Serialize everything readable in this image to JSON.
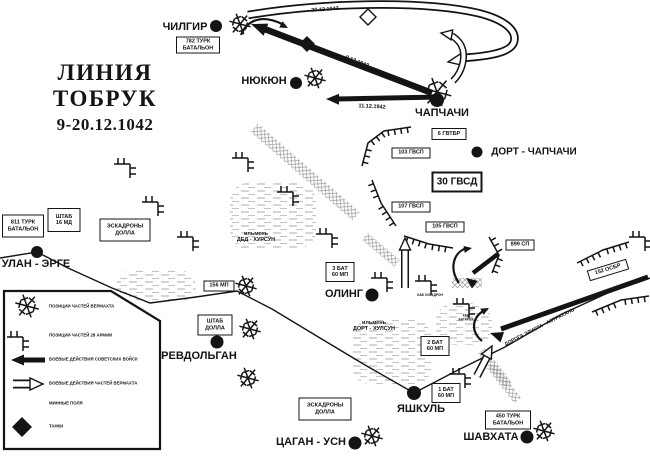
{
  "colors": {
    "ink": "#141414",
    "water": "#b4b4b4",
    "mine": "#9a9a9a",
    "bg": "#ffffff"
  },
  "title": {
    "line1": "ЛИНИЯ  ТОБРУК",
    "line2": "9-20.12.1042"
  },
  "towns": [
    {
      "name": "ЧИЛГИР",
      "dot": [
        216,
        26
      ],
      "r": 6,
      "label": [
        185,
        27
      ],
      "fs": 11
    },
    {
      "name": "НЮКЮН",
      "dot": [
        296,
        83
      ],
      "r": 6,
      "label": [
        264,
        81
      ],
      "fs": 11
    },
    {
      "name": "ЧАПЧАЧИ",
      "dot": [
        437,
        100
      ],
      "r": 7,
      "label": [
        442,
        113
      ],
      "fs": 11
    },
    {
      "name": "ДОРТ - ЧАПЧАЧИ",
      "dot": [
        477,
        152
      ],
      "r": 5.5,
      "label": [
        534,
        152
      ],
      "fs": 10
    },
    {
      "name": "УЛАН - ЭРГЕ",
      "dot": [
        37,
        252
      ],
      "r": 6,
      "label": [
        36,
        264
      ],
      "fs": 11
    },
    {
      "name": "РЕВДОЛЬГАН",
      "dot": [
        217,
        342
      ],
      "r": 6.5,
      "label": [
        199,
        356
      ],
      "fs": 11
    },
    {
      "name": "ОЛИНГ",
      "dot": [
        372,
        295
      ],
      "r": 6.5,
      "label": [
        344,
        294
      ],
      "fs": 11
    },
    {
      "name": "ЯШКУЛЬ",
      "dot": [
        414,
        393
      ],
      "r": 7,
      "label": [
        421,
        409
      ],
      "fs": 11
    },
    {
      "name": "ЦАГАН - УСН",
      "dot": [
        355,
        443
      ],
      "r": 6.5,
      "label": [
        311,
        442
      ],
      "fs": 11
    },
    {
      "name": "ШАВХАТА",
      "dot": [
        527,
        437
      ],
      "r": 6.5,
      "label": [
        491,
        437
      ],
      "fs": 11
    }
  ],
  "unit_boxes": [
    {
      "lines": [
        "782 ТУРК",
        "БАТАЛЬОН"
      ],
      "c": [
        198,
        45
      ],
      "w": 44,
      "h": 17,
      "fs": 5.5,
      "bw": 1.3,
      "rot": 0
    },
    {
      "lines": [
        "811 ТУРК",
        "БАТАЛЬОН"
      ],
      "c": [
        23,
        226
      ],
      "w": 42,
      "h": 23,
      "fs": 5.5,
      "bw": 1.3,
      "rot": 0
    },
    {
      "lines": [
        "ШТАБ",
        "16 МД"
      ],
      "c": [
        64,
        220
      ],
      "w": 33,
      "h": 24,
      "fs": 5.5,
      "bw": 1.8,
      "rot": 0
    },
    {
      "lines": [
        "ЭСКАДРОНЫ",
        "ДОЛЛА"
      ],
      "c": [
        125,
        230
      ],
      "w": 51,
      "h": 23,
      "fs": 5.5,
      "bw": 1.3,
      "rot": 0
    },
    {
      "lines": [
        "156 МП"
      ],
      "c": [
        219,
        286
      ],
      "w": 31,
      "h": 11,
      "fs": 5.5,
      "bw": 1.3,
      "rot": 0
    },
    {
      "lines": [
        "ШТАБ",
        "ДОЛЛА"
      ],
      "c": [
        215,
        325
      ],
      "w": 35,
      "h": 21,
      "fs": 5.5,
      "bw": 1.8,
      "rot": 0
    },
    {
      "lines": [
        "ЭСКАДРОНЫ",
        "ДОЛЛА"
      ],
      "c": [
        325,
        409
      ],
      "w": 53,
      "h": 23,
      "fs": 5.5,
      "bw": 1.3,
      "rot": 0
    },
    {
      "lines": [
        "6 ГВТБР"
      ],
      "c": [
        449,
        134
      ],
      "w": 35,
      "h": 12,
      "fs": 5.5,
      "bw": 1.3,
      "rot": 0
    },
    {
      "lines": [
        "103 ГВСП"
      ],
      "c": [
        411,
        153
      ],
      "w": 39,
      "h": 11,
      "fs": 5.5,
      "bw": 1.3,
      "rot": 0
    },
    {
      "lines": [
        "30 ГВСД"
      ],
      "c": [
        457,
        182
      ],
      "w": 51,
      "h": 21,
      "fs": 10,
      "bw": 2.6,
      "rot": 0
    },
    {
      "lines": [
        "107 ГВСП"
      ],
      "c": [
        411,
        207
      ],
      "w": 39,
      "h": 11,
      "fs": 5.5,
      "bw": 1.3,
      "rot": 0
    },
    {
      "lines": [
        "105 ГВСП"
      ],
      "c": [
        445,
        227
      ],
      "w": 39,
      "h": 11,
      "fs": 5.5,
      "bw": 1.3,
      "rot": 0
    },
    {
      "lines": [
        "899 СП"
      ],
      "c": [
        520,
        245
      ],
      "w": 29,
      "h": 11,
      "fs": 5.5,
      "bw": 1.3,
      "rot": 0
    },
    {
      "lines": [
        "152 ОСБР"
      ],
      "c": [
        608,
        270
      ],
      "w": 41,
      "h": 11,
      "fs": 5.5,
      "bw": 1.3,
      "rot": -17
    },
    {
      "lines": [
        "3 БАТ",
        "60 МП"
      ],
      "c": [
        340,
        272
      ],
      "w": 29,
      "h": 20,
      "fs": 5.5,
      "bw": 1.3,
      "rot": 0
    },
    {
      "lines": [
        "2 БАТ",
        "60 МП"
      ],
      "c": [
        435,
        346
      ],
      "w": 29,
      "h": 20,
      "fs": 5.5,
      "bw": 1.3,
      "rot": 0
    },
    {
      "lines": [
        "1 БАТ",
        "60 МП"
      ],
      "c": [
        446,
        393
      ],
      "w": 29,
      "h": 20,
      "fs": 5.5,
      "bw": 1.3,
      "rot": 0
    },
    {
      "lines": [
        "450 ТУРК",
        "БАТАЛЬОН"
      ],
      "c": [
        508,
        420
      ],
      "w": 46,
      "h": 19,
      "fs": 5.5,
      "bw": 1.3,
      "rot": 0
    }
  ],
  "map_labels": [
    {
      "lines": [
        "20.12.1942"
      ],
      "c": [
        325,
        10
      ],
      "fs": 5.5,
      "rot": -4
    },
    {
      "lines": [
        "9.12.1942"
      ],
      "c": [
        357,
        62
      ],
      "fs": 5.5,
      "rot": 21
    },
    {
      "lines": [
        "11.12.1942"
      ],
      "c": [
        372,
        107
      ],
      "fs": 5.5,
      "rot": 3
    },
    {
      "lines": [
        "ильмень",
        "ДЕД - ХУРСУН"
      ],
      "c": [
        256,
        237
      ],
      "fs": 5.5,
      "rot": 0
    },
    {
      "lines": [
        "ильмень",
        "ДОРТ - ХУЛСУН"
      ],
      "c": [
        374,
        326
      ],
      "fs": 5.5,
      "rot": 0
    },
    {
      "lines": [
        "ДОРОГА ЭЛИСТА - АСТРАХАНЬ"
      ],
      "c": [
        540,
        328
      ],
      "fs": 5,
      "rot": -27
    },
    {
      "lines": [
        "КАВ ЭСКАДРОН"
      ],
      "c": [
        430,
        296
      ],
      "fs": 3.2,
      "rot": 0
    },
    {
      "lines": [
        "КАВ",
        "БАТАРЕЯ"
      ],
      "c": [
        466,
        318
      ],
      "fs": 3.2,
      "rot": 0
    }
  ],
  "legend": {
    "box_points": "4,291 111,291 160,321 160,449 4,449",
    "label_x": 49,
    "items": [
      {
        "symbol": "wehrmacht-position-symbol",
        "label": "ПОЗИЦИИ ЧАСТЕЙ ВЕРМАХТА",
        "y": 307
      },
      {
        "symbol": "army28-position-symbol",
        "label": "ПОЗИЦИИ ЧАСТЕЙ 28 АРМИИ",
        "y": 336
      },
      {
        "symbol": "soviet-attack-arrow",
        "label": "БОЕВЫЕ ДЕЙСТВИЯ СОВЕТСКИХ ВОЙСК",
        "y": 360
      },
      {
        "symbol": "wehrmacht-attack-arrow",
        "label": "БОЕВЫЕ ДЕЙСТВИЯ ЧАСТЕЙ ВЕРМАХТА",
        "y": 384
      },
      {
        "symbol": "minefield-symbol",
        "label": "МИННЫЕ ПОЛЯ",
        "y": 404
      },
      {
        "symbol": "tank-symbol",
        "label": "ТАНКИ",
        "y": 427
      }
    ]
  },
  "roads": [
    [
      [
        0,
        258
      ],
      [
        37,
        252
      ],
      [
        68,
        268
      ],
      [
        112,
        288
      ],
      [
        150,
        303
      ],
      [
        196,
        297
      ],
      [
        237,
        291
      ],
      [
        272,
        309
      ],
      [
        320,
        338
      ],
      [
        365,
        365
      ],
      [
        414,
        393
      ]
    ],
    [
      [
        414,
        393
      ],
      [
        460,
        369
      ],
      [
        505,
        347
      ],
      [
        562,
        314
      ],
      [
        612,
        291
      ],
      [
        650,
        278
      ]
    ]
  ],
  "lakes": [
    {
      "x": 230,
      "y": 183,
      "w": 86,
      "h": 66
    },
    {
      "x": 116,
      "y": 270,
      "w": 80,
      "h": 32
    },
    {
      "x": 352,
      "y": 320,
      "w": 80,
      "h": 64
    },
    {
      "x": 436,
      "y": 303,
      "w": 56,
      "h": 42
    }
  ],
  "minefields": [
    {
      "c": [
        305,
        172
      ],
      "w": 135,
      "h": 11,
      "rot": 41
    },
    {
      "c": [
        381,
        250
      ],
      "w": 42,
      "h": 9,
      "rot": 40
    },
    {
      "c": [
        467,
        283
      ],
      "w": 30,
      "h": 10,
      "rot": 0
    },
    {
      "c": [
        495,
        368
      ],
      "w": 44,
      "h": 9,
      "rot": 52
    },
    {
      "c": [
        504,
        383
      ],
      "w": 44,
      "h": 9,
      "rot": 52
    },
    {
      "c": [
        24,
        405
      ],
      "w": 25,
      "h": 15,
      "rot": 0
    }
  ],
  "combs": [
    {
      "pts": [
        [
          362,
          166
        ],
        [
          368,
          143
        ],
        [
          384,
          131
        ],
        [
          411,
          127
        ]
      ],
      "side": -1
    },
    {
      "pts": [
        [
          372,
          180
        ],
        [
          381,
          203
        ],
        [
          396,
          226
        ]
      ],
      "side": -1
    },
    {
      "pts": [
        [
          404,
          236
        ],
        [
          429,
          244
        ],
        [
          453,
          248
        ]
      ],
      "side": -1
    },
    {
      "pts": [
        [
          489,
          237
        ],
        [
          499,
          255
        ],
        [
          492,
          273
        ]
      ],
      "side": 1
    },
    {
      "pts": [
        [
          577,
          263
        ],
        [
          603,
          250
        ],
        [
          629,
          242
        ]
      ],
      "side": -1
    },
    {
      "pts": [
        [
          592,
          312
        ],
        [
          621,
          300
        ],
        [
          649,
          296
        ]
      ],
      "side": -1
    }
  ],
  "hedgehogs": [
    {
      "c": [
        240,
        24
      ],
      "s": 1
    },
    {
      "c": [
        315,
        78
      ],
      "s": 1
    },
    {
      "c": [
        437,
        92
      ],
      "s": 1.35
    },
    {
      "c": [
        246,
        286
      ],
      "s": 1
    },
    {
      "c": [
        250,
        329
      ],
      "s": 1
    },
    {
      "c": [
        248,
        378
      ],
      "s": 1
    },
    {
      "c": [
        372,
        436
      ],
      "s": 1
    },
    {
      "c": [
        544,
        431
      ],
      "s": 1
    },
    {
      "c": [
        27,
        306
      ],
      "s": 1.1
    }
  ],
  "brackets": [
    {
      "c": [
        125,
        164
      ]
    },
    {
      "c": [
        153,
        202
      ]
    },
    {
      "c": [
        188,
        237
      ]
    },
    {
      "c": [
        243,
        158
      ]
    },
    {
      "c": [
        288,
        192
      ]
    },
    {
      "c": [
        327,
        234
      ]
    },
    {
      "c": [
        382,
        278
      ]
    },
    {
      "c": [
        426,
        281
      ]
    },
    {
      "c": [
        464,
        304
      ]
    },
    {
      "c": [
        460,
        374
      ]
    },
    {
      "c": [
        640,
        237
      ]
    },
    {
      "c": [
        18,
        337
      ]
    }
  ],
  "diamonds": [
    {
      "c": [
        307,
        44
      ],
      "s": 7,
      "hollow": false
    },
    {
      "c": [
        368,
        17
      ],
      "s": 8,
      "hollow": true
    },
    {
      "c": [
        22,
        427
      ],
      "s": 9,
      "hollow": false
    }
  ],
  "solid_arrows": [
    {
      "pts": [
        [
          432,
          93
        ],
        [
          262,
          28
        ]
      ],
      "w": 6.5,
      "head": [
        251,
        24,
        201,
        16,
        13
      ]
    },
    {
      "pts": [
        [
          441,
          97
        ],
        [
          337,
          99
        ]
      ],
      "w": 5,
      "head": [
        326,
        99,
        181,
        13,
        11
      ]
    },
    {
      "pts": [
        [
          648,
          277
        ],
        [
          501,
          329
        ]
      ],
      "w": 5,
      "head": [
        490,
        333,
        199,
        13,
        11
      ]
    },
    {
      "pts": [
        [
          498,
          254
        ],
        [
          473,
          273
        ]
      ],
      "w": 4.5,
      "head": [
        466,
        278,
        217,
        11,
        9.5
      ]
    },
    {
      "path": "M241 35 C247 20 262 14 282 24",
      "w": 2.2,
      "head": [
        288,
        28,
        27,
        8,
        7
      ]
    },
    {
      "path": "M459 283 C449 269 453 252 467 248",
      "w": 2.2,
      "head": [
        472,
        248,
        -10,
        8,
        7
      ]
    },
    {
      "path": "M482 341 C470 331 472 317 485 310",
      "w": 2.2,
      "head": [
        489,
        308,
        -28,
        8,
        7
      ]
    },
    {
      "pts": [
        [
          45,
          360
        ],
        [
          17,
          360
        ]
      ],
      "w": 5,
      "head": [
        11,
        360,
        180,
        13,
        11
      ]
    }
  ],
  "hollow_arrows": [
    {
      "path": "M248 15 C320 3 420 0 478 13 C506 20 517 31 514 42 C511 52 492 56 462 58",
      "bw": 8.5,
      "iw": 5,
      "head": [
        448,
        62,
        170,
        14,
        12
      ]
    },
    {
      "path": "M453 81 C464 70 467 52 459 42 C455 37 451 35 447 34",
      "bw": 7,
      "iw": 4,
      "head": [
        441,
        33,
        190,
        11,
        10
      ]
    },
    {
      "path": "M405 288 L405 246",
      "bw": 8,
      "iw": 5,
      "head": [
        405,
        238,
        -90,
        12,
        11
      ]
    },
    {
      "path": "M477 376 L489 353",
      "bw": 8,
      "iw": 5,
      "head": [
        492,
        346,
        -62,
        12,
        11
      ]
    },
    {
      "path": "M13 384 L35 384",
      "bw": 9,
      "iw": 5.5,
      "head": [
        43,
        384,
        0,
        13,
        12
      ]
    }
  ]
}
